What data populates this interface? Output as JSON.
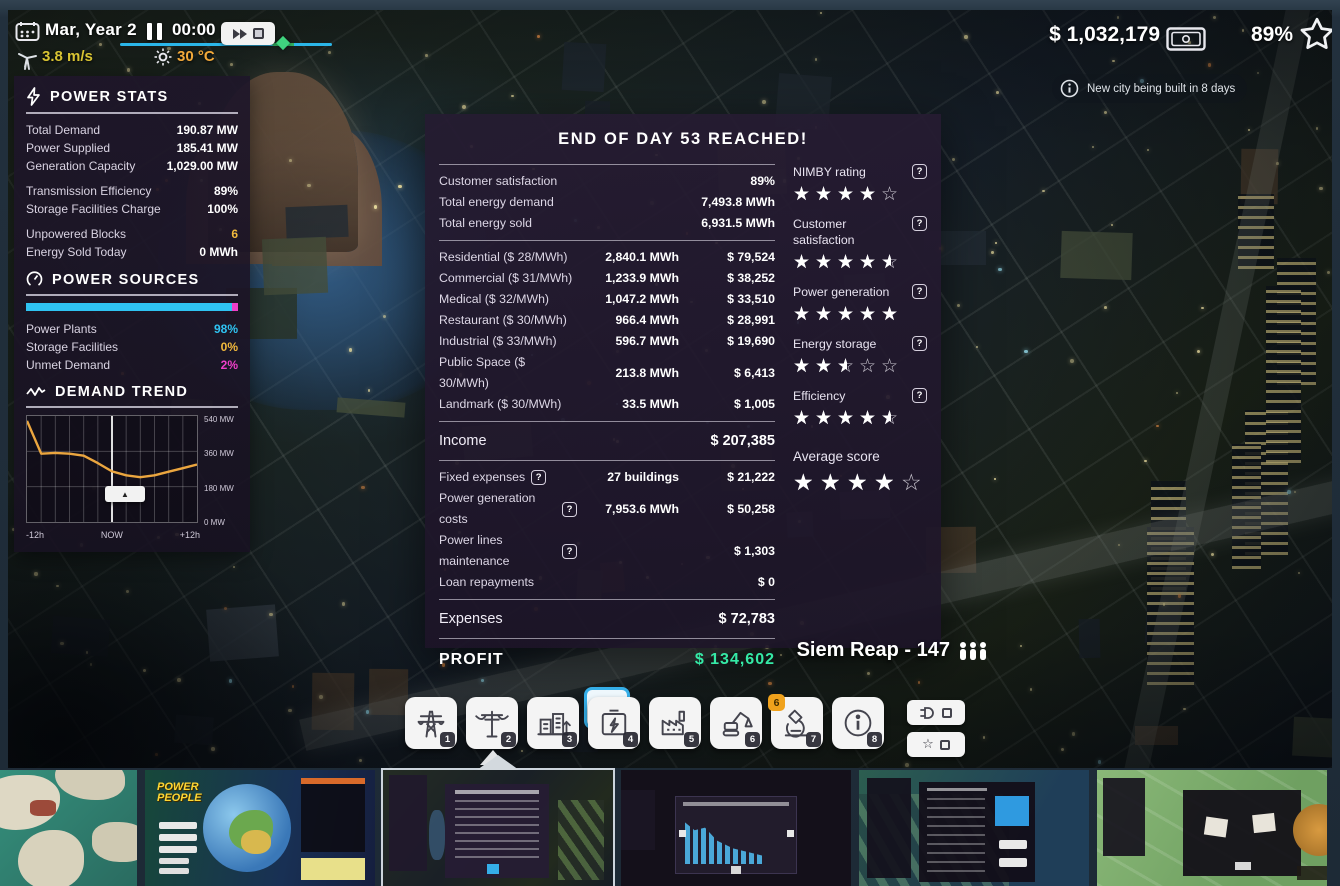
{
  "icons": {
    "help": "?",
    "collapse": "▲",
    "star_full": "★",
    "star_empty": "☆"
  },
  "topbar": {
    "date": "Mar, Year 2",
    "time": "00:00",
    "wind_speed": "3.8 m/s",
    "temperature": "30 °C",
    "money": "$ 1,032,179",
    "city_rating": "89%",
    "notification": "New city being built in 8 days"
  },
  "power_stats": {
    "title": "POWER STATS",
    "rows": [
      {
        "label": "Total Demand",
        "value": "190.87 MW"
      },
      {
        "label": "Power Supplied",
        "value": "185.41 MW"
      },
      {
        "label": "Generation Capacity",
        "value": "1,029.00 MW"
      },
      {
        "label": "Transmission Efficiency",
        "value": "89%"
      },
      {
        "label": "Storage Facilities Charge",
        "value": "100%"
      },
      {
        "label": "Unpowered Blocks",
        "value": "6"
      },
      {
        "label": "Energy Sold Today",
        "value": "0 MWh"
      }
    ]
  },
  "power_sources": {
    "title": "POWER SOURCES",
    "segments": [
      {
        "label": "Power Plants",
        "value": "98%",
        "pct": 97,
        "color": "#2fc3f2"
      },
      {
        "label": "Storage Facilities",
        "value": "0%",
        "pct": 0,
        "color": "#f2b93c"
      },
      {
        "label": "Unmet Demand",
        "value": "2%",
        "pct": 3,
        "color": "#ee3fc8"
      }
    ]
  },
  "demand_trend": {
    "title": "DEMAND TREND",
    "chart_data": {
      "type": "line",
      "title": "DEMAND TREND",
      "x": [
        -12,
        -10,
        -8,
        -6,
        -4,
        -2,
        0,
        2,
        4,
        6,
        8,
        10,
        12
      ],
      "values": [
        515,
        348,
        352,
        348,
        338,
        300,
        258,
        238,
        228,
        238,
        256,
        274,
        293
      ],
      "x_labels": [
        "-12h",
        "NOW",
        "+12h"
      ],
      "y_tick_labels": [
        "540 MW",
        "360 MW",
        "180 MW",
        "0 MW"
      ],
      "ylim": [
        0,
        540
      ],
      "unit": "MW",
      "grid": true,
      "legend": "none",
      "line_color": "#eba63f"
    }
  },
  "dialog": {
    "title": "END OF DAY 53 REACHED!",
    "summary_rows": [
      {
        "label": "Customer satisfaction",
        "value": "89%"
      },
      {
        "label": "Total energy demand",
        "value": "7,493.8 MWh"
      },
      {
        "label": "Total energy sold",
        "value": "6,931.5 MWh"
      }
    ],
    "revenue_rows": [
      {
        "label": "Residential ($ 28/MWh)",
        "energy": "2,840.1 MWh",
        "amount": "$ 79,524"
      },
      {
        "label": "Commercial ($ 31/MWh)",
        "energy": "1,233.9 MWh",
        "amount": "$ 38,252"
      },
      {
        "label": "Medical ($ 32/MWh)",
        "energy": "1,047.2 MWh",
        "amount": "$ 33,510"
      },
      {
        "label": "Restaurant ($ 30/MWh)",
        "energy": "966.4 MWh",
        "amount": "$ 28,991"
      },
      {
        "label": "Industrial ($ 33/MWh)",
        "energy": "596.7 MWh",
        "amount": "$ 19,690"
      },
      {
        "label": "Public Space ($ 30/MWh)",
        "energy": "213.8 MWh",
        "amount": "$ 6,413"
      },
      {
        "label": "Landmark ($ 30/MWh)",
        "energy": "33.5 MWh",
        "amount": "$ 1,005"
      }
    ],
    "income": {
      "label": "Income",
      "value": "$ 207,385"
    },
    "expense_rows": [
      {
        "label": "Fixed expenses",
        "qty": "27 buildings",
        "amount": "$ 21,222"
      },
      {
        "label": "Power generation costs",
        "qty": "7,953.6 MWh",
        "amount": "$ 50,258"
      },
      {
        "label": "Power lines maintenance",
        "qty": "",
        "amount": "$ 1,303"
      },
      {
        "label": "Loan repayments",
        "qty": "",
        "amount": "$ 0"
      }
    ],
    "expenses": {
      "label": "Expenses",
      "value": "$ 72,783"
    },
    "profit": {
      "label": "PROFIT",
      "value": "$ 134,602"
    },
    "ratings": [
      {
        "label": "NIMBY rating",
        "stars": 4
      },
      {
        "label": "Customer satisfaction",
        "stars": 4.5
      },
      {
        "label": "Power generation",
        "stars": 5
      },
      {
        "label": "Energy storage",
        "stars": 2.5
      },
      {
        "label": "Efficiency",
        "stars": 4.5
      },
      {
        "label": "Average score",
        "stars": 4
      }
    ]
  },
  "city_label": "Siem Reap - 147",
  "toolbar": {
    "buttons": [
      {
        "name": "transmission-towers",
        "hotkey": "1"
      },
      {
        "name": "power-lines",
        "hotkey": "2"
      },
      {
        "name": "consumers",
        "hotkey": "3"
      },
      {
        "name": "batteries",
        "hotkey": "4"
      },
      {
        "name": "power-plants",
        "hotkey": "5"
      },
      {
        "name": "demolish",
        "hotkey": "6"
      },
      {
        "name": "research",
        "hotkey": "7",
        "badge": "6"
      },
      {
        "name": "info",
        "hotkey": "8"
      }
    ]
  },
  "thumbnails": {
    "logo_line1": "POWER",
    "logo_line2": "PEOPLE"
  }
}
